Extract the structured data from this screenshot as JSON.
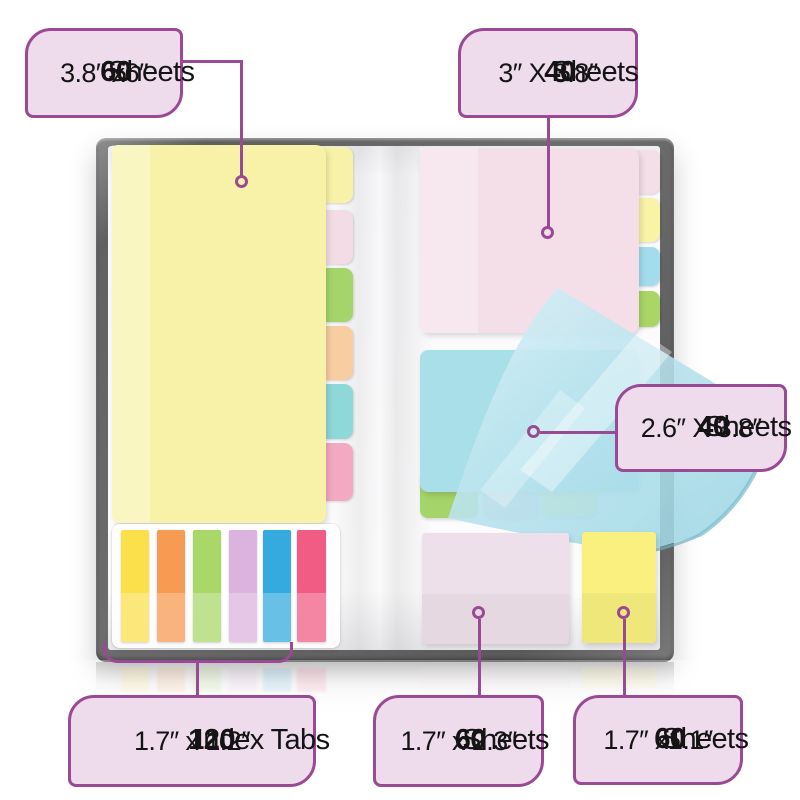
{
  "palette": {
    "accent_purple": "#9a4a94",
    "callout_fill": "#eedbec",
    "callout_text": "#141414",
    "cover_gray": "#646464",
    "page_white": "#fbfbfd"
  },
  "callouts": [
    {
      "count": "60",
      "unit": "Sheets",
      "size": "3.8″ x6″"
    },
    {
      "count": "40",
      "unit": "Sheets",
      "size": "3″ X 3.8″"
    },
    {
      "count": "40",
      "unit": "Sheets",
      "size": "2.6″ X 3.8″"
    },
    {
      "count": "120",
      "unit": "Index Tabs",
      "size": "1.7″ x 1.2″"
    },
    {
      "count": "60",
      "unit": "Sheets",
      "size": "1.7″ x 2.3″"
    },
    {
      "count": "60",
      "unit": "Sheets",
      "size": "1.7″ x1.1″"
    }
  ],
  "product": {
    "pads": {
      "large_yellow": "#f8f2a8",
      "pink": "#f4dee8",
      "blue": "#a8dfe9",
      "small_pink": "#eee0ea",
      "small_yellow": "#f9f080"
    },
    "left_divider_tabs": [
      "#f3dce6",
      "#a5d46a",
      "#f7cda1",
      "#8fd8da",
      "#f3a9c2"
    ],
    "right_divider_tabs": [
      "#f9f3a6",
      "#a3dced",
      "#a9d665"
    ],
    "bottom_divider_tabs": [
      "#a5d46a",
      "#f0d8e2",
      "#f6f0a0"
    ],
    "index_tabs": [
      "#fbe04c",
      "#f79a52",
      "#a8d868",
      "#dcb3de",
      "#35aade",
      "#f05c84"
    ]
  }
}
